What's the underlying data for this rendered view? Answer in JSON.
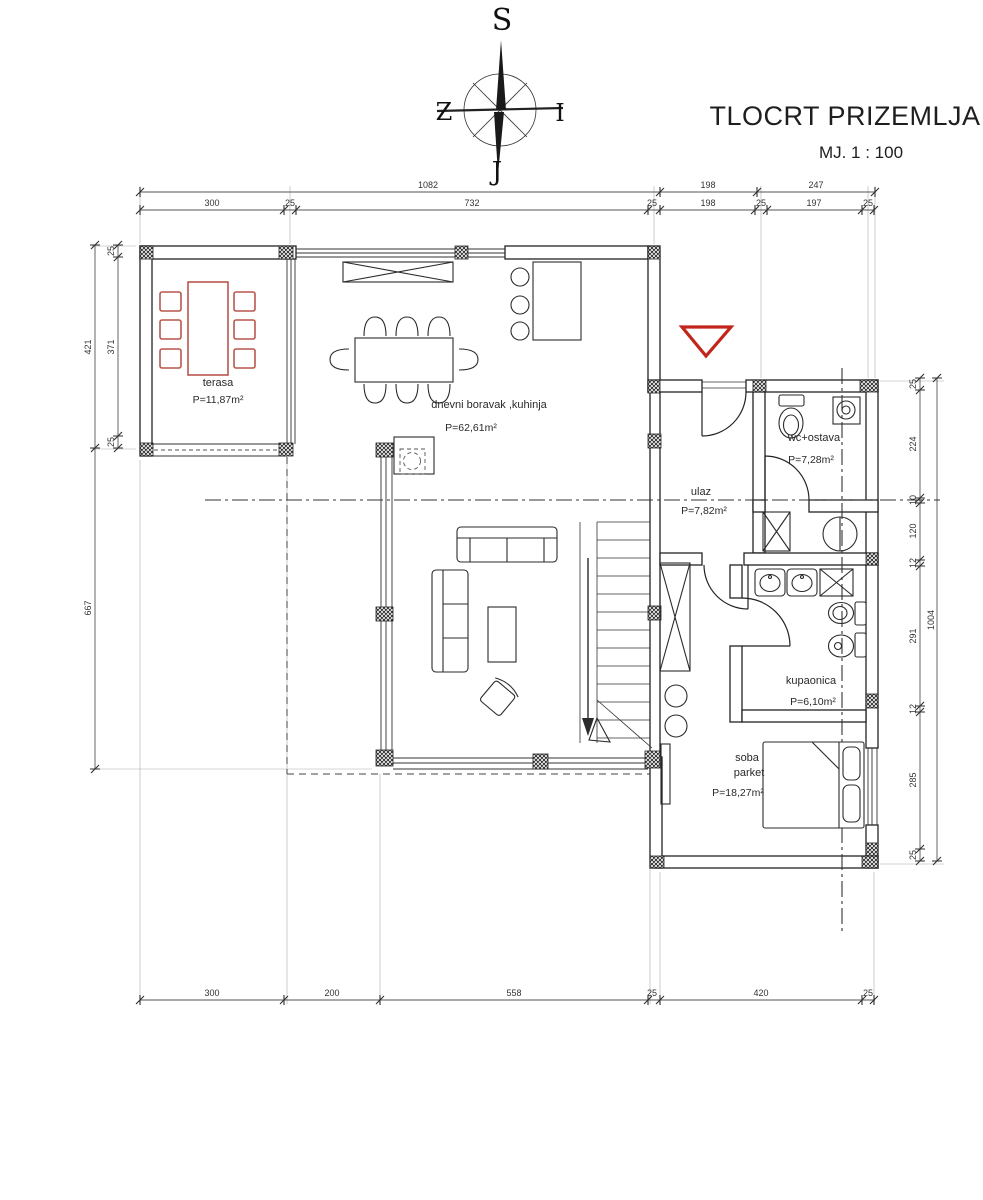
{
  "title": {
    "main": "TLOCRT PRIZEMLJA",
    "scale": "MJ. 1 : 100"
  },
  "compass": {
    "top": "S",
    "left": "Z",
    "right": "I",
    "bottom": "J"
  },
  "rooms": {
    "terasa": {
      "name": "terasa",
      "area": "P=11,87m²"
    },
    "dnevni": {
      "name": "dnevni boravak ,kuhinja",
      "area": "P=62,61m²"
    },
    "ulaz": {
      "name": "ulaz",
      "area": "P=7,82m²"
    },
    "wc": {
      "name": "wc+ostava",
      "area": "P=7,28m²"
    },
    "kupaonica": {
      "name": "kupaonica",
      "area": "P=6,10m²"
    },
    "soba": {
      "name": "soba",
      "material": "parket",
      "area": "P=18,27m²"
    }
  },
  "dimensions": {
    "top_row1": [
      "1082",
      "198",
      "247"
    ],
    "top_row2": [
      "300",
      "25",
      "732",
      "25",
      "198",
      "25",
      "197",
      "25"
    ],
    "left_outer": [
      "421",
      "667"
    ],
    "left_inner": [
      "25",
      "371",
      "25"
    ],
    "right_inner": [
      "25",
      "224",
      "10",
      "120",
      "12",
      "291",
      "12",
      "285",
      "25"
    ],
    "right_outer": [
      "1004"
    ],
    "bottom": [
      "300",
      "200",
      "558",
      "25",
      "420",
      "25"
    ]
  },
  "colors": {
    "accent_red": "#c2251a",
    "furniture_red": "#b9564c",
    "line": "#222222"
  }
}
